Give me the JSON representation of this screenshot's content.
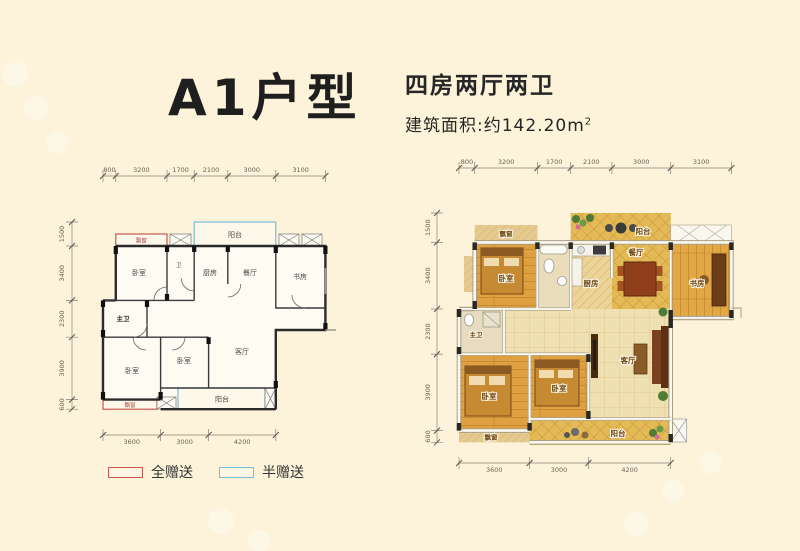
{
  "header": {
    "title": "A1户型",
    "layout": "四房两厅两卫",
    "area": "建筑面积:约142.20m",
    "area_sup": "2"
  },
  "legend": {
    "full": "全赠送",
    "half": "半赠送",
    "full_color": "#c9574d",
    "half_color": "#79bed4"
  },
  "dims": {
    "top": [
      "800",
      "3200",
      "1700",
      "2100",
      "3000",
      "3100"
    ],
    "side": [
      "1500",
      "3400",
      "2300",
      "3900",
      "600"
    ],
    "bottom": [
      "3600",
      "3000",
      "4200"
    ]
  },
  "rooms": {
    "bay_window": "飘窗",
    "balcony": "阳台",
    "bedroom": "卧室",
    "bath": "卫",
    "kitchen": "厨房",
    "dining": "餐厅",
    "study": "书房",
    "master_bath": "主卫",
    "living": "客厅"
  },
  "colors": {
    "background": "#fcf3da",
    "wall": "#2b2b2b",
    "wood_floor": "#dfa041",
    "gold_tile": "#e4ba58",
    "pale_tile": "#efe0b2"
  }
}
